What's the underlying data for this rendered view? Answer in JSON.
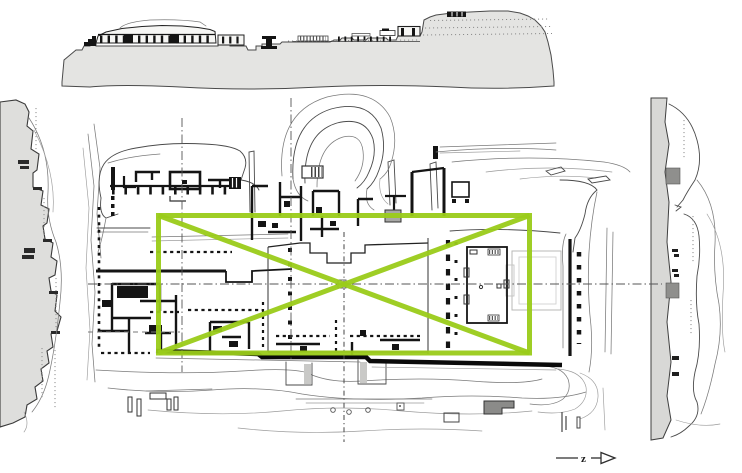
{
  "figure": {
    "kind": "scanned-architectural-site-drawing",
    "north_arrow_label": "z"
  },
  "colors": {
    "overlay_green": "#9ACB19",
    "paper": "#ffffff",
    "ink": "#141414",
    "elevation_fill_gray": "#e4e4e2",
    "left_section_fill_gray": "#dededc",
    "right_section_fill_gray": "#d8d8d6"
  },
  "panels": {
    "top": "hill-elevation-profile",
    "left": "west-slope-section-profile",
    "right": "east-slope-section-profile",
    "center": "palace-ground-plan",
    "overlay": "green-rectangle-with-diagonals",
    "marker": "north-arrow"
  }
}
